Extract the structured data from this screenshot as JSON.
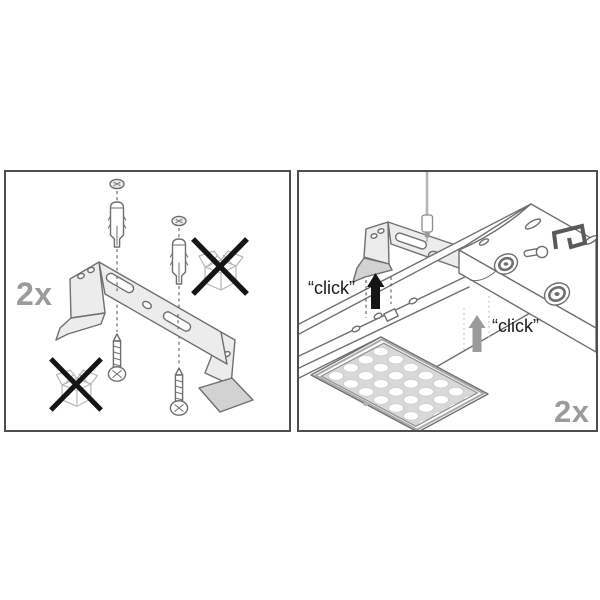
{
  "colors": {
    "panel_border": "#4e4e4e",
    "line_art": "#6f6f6f",
    "black_accent": "#151515",
    "metal_fill": "#ececec",
    "metal_dark_fill": "#d2d2d2",
    "gray_label": "#9b9b9b",
    "led_bed": "#d8d8d8"
  },
  "left_panel": {
    "quantity_label": "2x"
  },
  "right_panel": {
    "click_label_top": "“click”",
    "click_label_bottom": "“click”",
    "quantity_label": "2x"
  }
}
